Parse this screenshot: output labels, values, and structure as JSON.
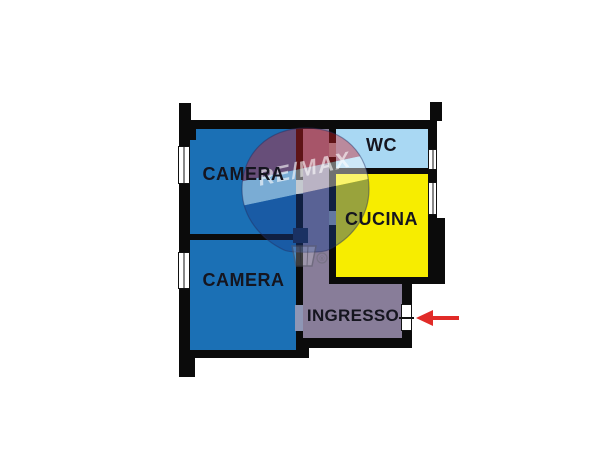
{
  "floorplan": {
    "title": "apartment-floor-plan",
    "walls_color": "#0b0b0b",
    "label_color": "#15151f",
    "window_color": "#ffffff",
    "rooms": [
      {
        "id": "camera-top",
        "label": "CAMERA",
        "color": "#1B70B5"
      },
      {
        "id": "camera-bottom",
        "label": "CAMERA",
        "color": "#1B70B5"
      },
      {
        "id": "wc",
        "label": "WC",
        "color": "#A9D8F3"
      },
      {
        "id": "cucina",
        "label": "CUCINA",
        "color": "#F7ED00"
      },
      {
        "id": "ingresso",
        "label": "INGRESSO",
        "color": "#887D99"
      }
    ],
    "door_gap_light": "#9aa2ad",
    "door_gap_dark": "#1d2944",
    "door_gap_blue": "#8e96b5",
    "entrance": {
      "arrow_color": "#E12B28"
    },
    "watermark": {
      "brand": "RE/MAX",
      "registered": "®",
      "balloon_red": "#D22027",
      "balloon_white": "#FFFFFF",
      "balloon_blue": "#1A3F8F"
    }
  }
}
